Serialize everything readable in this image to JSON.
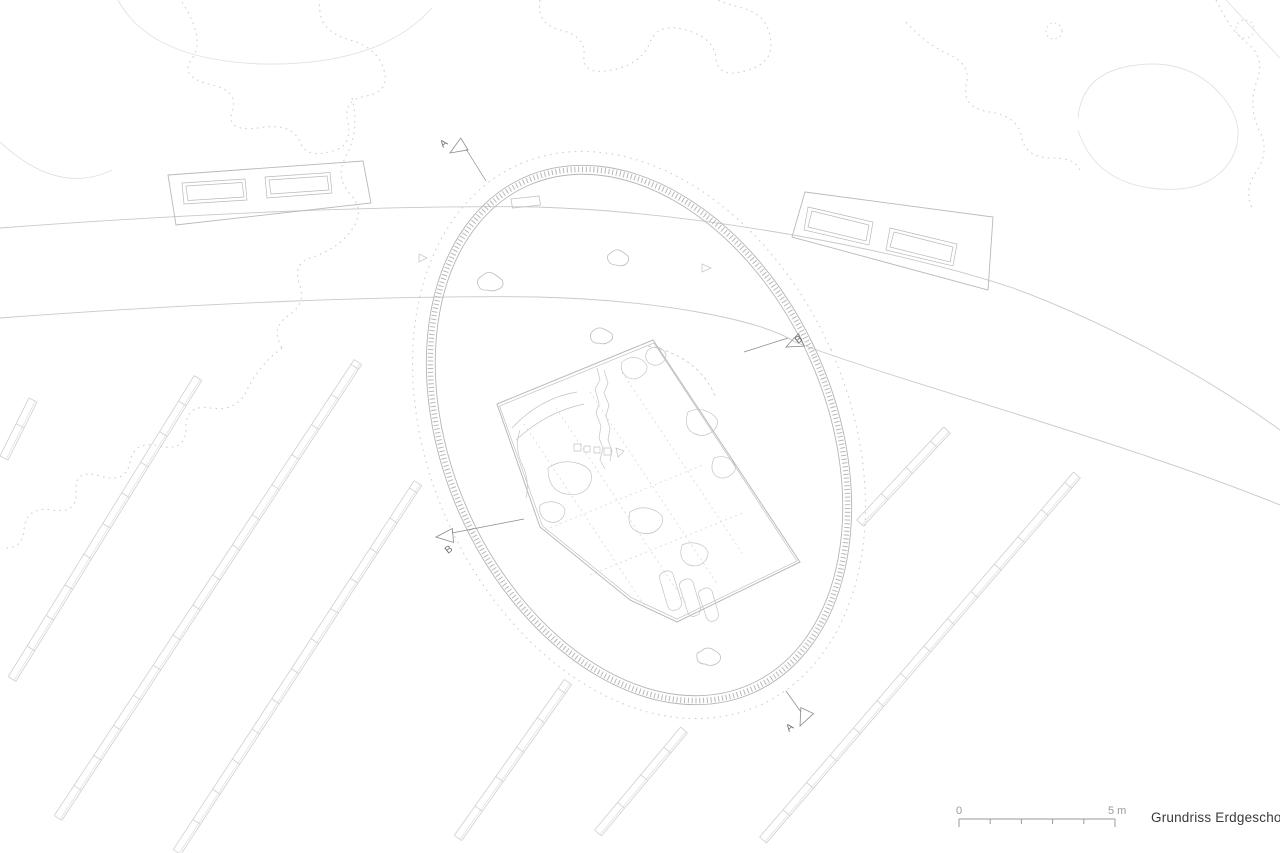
{
  "title": {
    "label": "Grundriss Erdgeschoss"
  },
  "scale_bar": {
    "start_label": "0",
    "end_label": "5 m"
  },
  "colors": {
    "hairline": "#c9c9c9",
    "light": "#d6d6d6",
    "lighter": "#e2e2e2",
    "veg_dot": "#cfcfcf",
    "ring": "#b5b5b5",
    "ring_band": "#b8b8b8",
    "ring_dot": "#cfcfcf",
    "building": "#b9b9b9",
    "stone": "#c4c4c4",
    "stone_dot": "#d9d9d9",
    "row": "#cfcfcf",
    "row_inner": "#dedede",
    "marker": "#8a8a8a",
    "marker_text": "#6e6e6e",
    "scale_line": "#9a9a9a",
    "scale_text": "#9a9a9a"
  },
  "section_markers": [
    {
      "letter": "A",
      "tip": [
        450,
        153
      ],
      "angle": 148,
      "label": [
        443,
        148
      ],
      "label_rot": -38,
      "stub": [
        466,
        149,
        486,
        181
      ]
    },
    {
      "letter": "B",
      "tip": [
        786,
        347
      ],
      "angle": 155,
      "label": [
        798,
        344
      ],
      "label_rot": -38,
      "stub": [
        744,
        352,
        788,
        338
      ]
    },
    {
      "letter": "B",
      "tip": [
        436,
        537
      ],
      "angle": 175,
      "label": [
        448,
        554
      ],
      "label_rot": -38,
      "stub": [
        452,
        533,
        524,
        519
      ]
    },
    {
      "letter": "A",
      "tip": [
        800,
        726
      ],
      "angle": 115,
      "label": [
        789,
        732
      ],
      "label_rot": -38,
      "stub": [
        786,
        691,
        801,
        712
      ]
    }
  ],
  "drawing": {
    "road": {
      "upper": "M0,228 C200,213 400,205 537,207 C700,212 900,250 1013,288 C1100,320 1200,372 1280,430",
      "lower": "M0,318 C200,303 400,295 537,297 C660,300 762,320 795,342 C900,382 1120,440 1280,505"
    },
    "ellipse": {
      "cx": 639,
      "cy": 435,
      "rx": 196,
      "ry": 282,
      "rot": -24,
      "dot_rx": 210,
      "dot_ry": 296,
      "band_rx": 192,
      "band_ry": 278,
      "inner_rx": 187,
      "inner_ry": 273
    },
    "rows": {
      "half_width": 4.5,
      "rung_step": 36,
      "lines": [
        [
          4,
          458,
          33,
          400
        ],
        [
          12,
          679,
          198,
          378
        ],
        [
          58,
          818,
          358,
          362
        ],
        [
          177,
          852,
          418,
          483
        ],
        [
          458,
          838,
          568,
          682
        ],
        [
          598,
          833,
          684,
          730
        ],
        [
          763,
          840,
          1077,
          475
        ],
        [
          860,
          523,
          947,
          430
        ]
      ]
    },
    "buildings": [
      {
        "outline": "M168,175 L363,161 L371,203 L176,225 Z",
        "inner": [
          "M182,183 L245,179 L247,200 L184,204 Z",
          "M186,186 L242,182.5 L244,197 L188,200.5 Z",
          "M265,177 L330,172.5 L332,193 L267,198 Z",
          "M269,180 L327,176 L329,190 L271,194 Z"
        ]
      },
      {
        "outline": "M805,192 L993,217 L988,290 L792,237 Z",
        "inner": [
          "M808,207 L873,222 L869,245 L804,230 Z",
          "M812,211 L869,225 L866,241 L808,227 Z",
          "M890,228 L957,244 L953,266 L886,250 Z",
          "M894,232 L953,247 L950,262 L890,247 Z"
        ]
      }
    ],
    "building_main": {
      "outline": "M497,404 L653,340 L800,562 L677,622 L630,600 L540,527 Z",
      "outline2": "M499.5,406 L654,343 L797,561 L677,619 L631,597.5 L542.5,526 Z",
      "dotted_lines": [
        "M524,424 L644,605",
        "M556,408 L686,604",
        "M590,392 L718,585",
        "M622,372 L742,553",
        "M545,530 L705,464",
        "M590,575 L745,512"
      ],
      "details": [
        "M512,428 Q540,398 577,392",
        "M516,440 Q546,412 584,404",
        "M520,430 q-6,18 2,34 q8,16 4,34",
        "M597,368 l3,12 -5,9 4,14 -3,10 5,13 -2,12 4,10 -3,12 5,9",
        "M604,370 l4,13 -4,10 5,12 -3,11 4,12 -2,12 4,11 -2,10",
        "M622,362 q10,-8 20,-2 q9,6 2,14 q-8,8 -17,3 q-8,-6 -5,-15",
        "M648,350 q8,-6 15,0 q6,6 0,12 q-7,6 -14,1 q-6,-6 -1,-13",
        "M688,412 q12,-6 24,2 q10,7 2,16 q-9,9 -21,3 q-10,-6 -5,-21",
        "M714,458 q10,-4 18,3 q7,7 0,13 q-8,7 -16,2 q-7,-6 -2,-18",
        "M548,468 q14,-10 32,-4 q16,6 10,20 q-6,13 -24,10 q-18,-3 -18,-26",
        "M540,505 q10,-6 20,-1 q8,5 3,13 q-6,8 -16,4 q-9,-5 -7,-16",
        "M630,512 q12,-8 26,-1 q11,6 4,16 q-8,10 -22,5 q-12,-5 -8,-20",
        "M682,545 q11,-5 21,1 q9,6 2,15 q-8,8 -18,3 q-9,-6 -5,-19",
        "M664,572 q6,-3 9,2 l8,26 q2,8 -5,10 q-7,2 -9,-6 l-7,-24 q-2,-6 4,-8",
        "M684,580 q6,-3 9,2 l7,24 q2,8 -5,10 q-6,2 -8,-6 l-7,-22 q-2,-6 4,-8",
        "M703,589 q6,-3 9,2 l6,21 q2,7 -4,9 q-6,2 -8,-5 l-7,-20 q-2,-5 4,-7",
        "M574,444h7v7h-7z M584,446h6v6h-6z M594,447h6v6h-6z M604,448h7v7h-7z",
        "M616,448 l8,3 -6,6 z"
      ],
      "dashed_arc": "M648,346 Q699,356 716,398"
    },
    "vegetation": {
      "dotted": [
        "M182,2 Q205,38 193,57 Q178,76 208,84 Q240,90 232,112 Q226,132 258,128 Q292,122 300,142 Q306,160 336,150 Q352,144 348,122 Q342,100 366,96 Q390,92 384,70 Q378,48 350,40 Q322,32 320,12 Q319,4 320,0",
        "M352,98 Q360,130 346,156 Q334,178 352,196 Q366,212 350,232 Q336,250 310,258 Q292,264 300,286 Q306,304 288,316 Q270,328 282,348",
        "M282,348 Q258,366 246,392 Q236,412 210,408 Q186,404 186,428 Q186,452 160,446 Q134,440 130,462 Q126,484 100,476 Q74,468 76,492 Q78,514 52,510 Q26,506 24,530 Q22,550 2,548",
        "M540,0 Q536,24 560,30 Q586,36 584,56 Q582,76 612,70 Q642,64 650,42 Q658,22 686,30 Q714,38 716,58 Q718,80 748,70 Q776,62 770,36 Q766,14 742,8 Q720,2 718,0",
        "M906,22 Q926,44 948,54 Q972,64 966,86 Q962,108 990,112 Q1018,116 1022,138 Q1026,158 1052,158 Q1078,158 1080,172",
        "M1216,0 Q1230,30 1248,44 Q1266,58 1256,84 Q1248,108 1260,132 Q1270,152 1256,172 Q1244,190 1252,208"
      ],
      "solid": [
        "M118,0 Q150,60 262,64 Q380,66 432,8",
        "M0,142 Q58,196 112,170",
        "M1078,118 Q1082,74 1130,66 Q1188,56 1222,96 Q1248,126 1232,158 Q1210,196 1150,188 Q1094,180 1078,130",
        "M1226,0 L1280,58"
      ],
      "dotted_circles": [
        [
          1054,
          31,
          8
        ],
        [
          1245,
          29,
          9
        ]
      ]
    },
    "items": {
      "bench": "M511,199 l28,-3 1.5,9 -28,3 z",
      "triangles": [
        "M702,264 l9,4 -9,4 z",
        "M419,254 l8,4 -8,4 z"
      ],
      "figures": [
        "M482,276q6,-6 12,-2t8,6q3,6-3,9t-12,1q-7,1-9,-5t4,-9",
        "M611,253q5,-5 10,-2t7,5q2,5-2,8t-10,1q-6,0-8,-5t3,-7",
        "M593,331q5,-5 11,-2t8,5q2,5-3,8t-10,1q-6,1-8,-4t2,-8",
        "M700,652q6,-6 12,-3t8,6q2,6-4,9t-11,0q-7,0-8,-6t3,-6"
      ]
    }
  }
}
